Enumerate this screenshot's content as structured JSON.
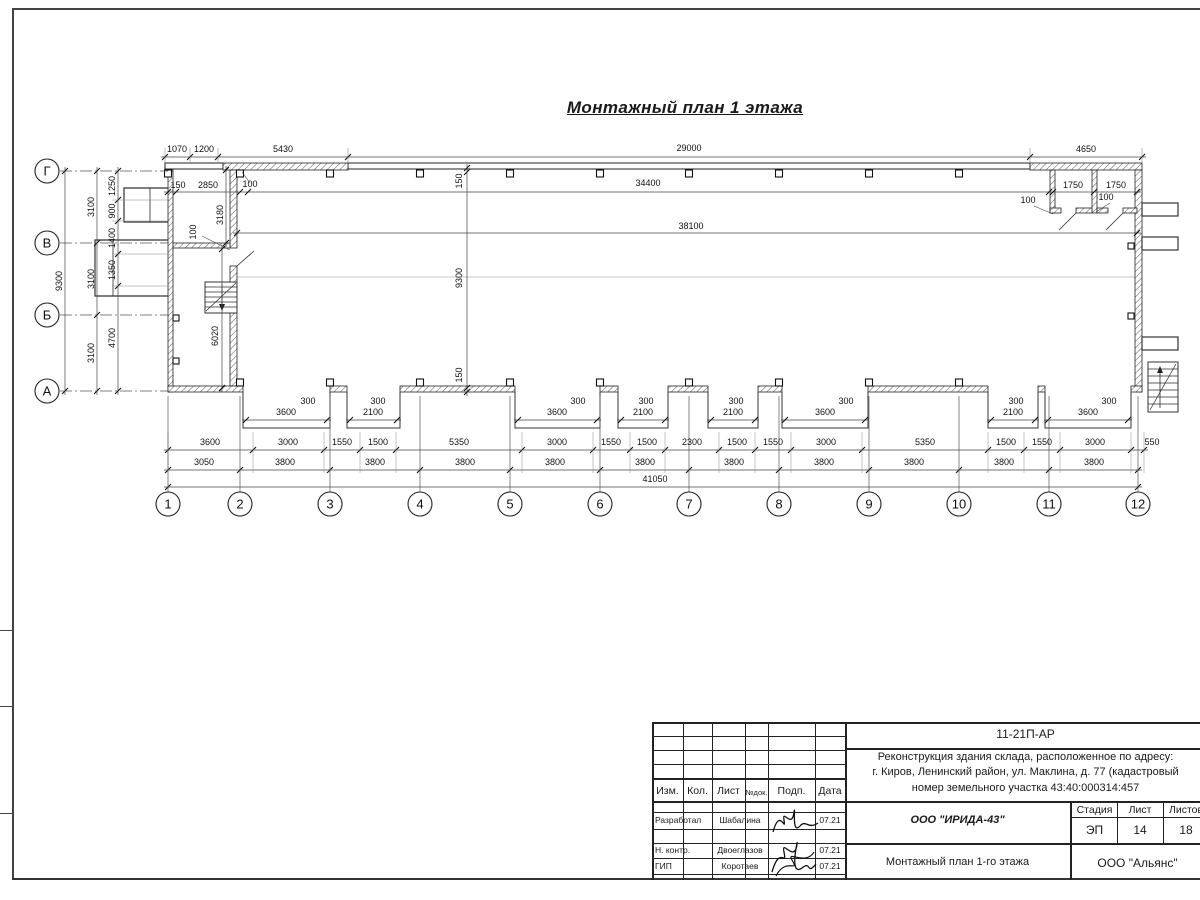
{
  "sheet": {
    "title": "Монтажный план 1 этажа"
  },
  "plan": {
    "axis_letters": [
      {
        "label": "Г",
        "y": 171
      },
      {
        "label": "В",
        "y": 243
      },
      {
        "label": "Б",
        "y": 315
      },
      {
        "label": "А",
        "y": 391
      }
    ],
    "axis_numbers": [
      {
        "label": "1",
        "x": 168
      },
      {
        "label": "2",
        "x": 240
      },
      {
        "label": "3",
        "x": 330
      },
      {
        "label": "4",
        "x": 420
      },
      {
        "label": "5",
        "x": 510
      },
      {
        "label": "6",
        "x": 600
      },
      {
        "label": "7",
        "x": 689
      },
      {
        "label": "8",
        "x": 779
      },
      {
        "label": "9",
        "x": 869
      },
      {
        "label": "10",
        "x": 959
      },
      {
        "label": "11",
        "x": 1049
      },
      {
        "label": "12",
        "x": 1138
      }
    ],
    "dim_labels": [
      {
        "t": "1070",
        "x": 177,
        "y": 152
      },
      {
        "t": "1200",
        "x": 204,
        "y": 152
      },
      {
        "t": "5430",
        "x": 283,
        "y": 152
      },
      {
        "t": "29000",
        "x": 689,
        "y": 151
      },
      {
        "t": "4650",
        "x": 1086,
        "y": 152
      },
      {
        "t": "150",
        "x": 178,
        "y": 188
      },
      {
        "t": "2850",
        "x": 208,
        "y": 188
      },
      {
        "t": "100",
        "x": 250,
        "y": 187
      },
      {
        "t": "34400",
        "x": 648,
        "y": 186
      },
      {
        "t": "1750",
        "x": 1073,
        "y": 188
      },
      {
        "t": "1750",
        "x": 1116,
        "y": 188
      },
      {
        "t": "100",
        "x": 1028,
        "y": 203
      },
      {
        "t": "100",
        "x": 1106,
        "y": 200
      },
      {
        "t": "38100",
        "x": 691,
        "y": 229
      },
      {
        "t": "3180",
        "x": 223,
        "y": 215,
        "r": 1
      },
      {
        "t": "100",
        "x": 196,
        "y": 232,
        "r": 1
      },
      {
        "t": "6020",
        "x": 218,
        "y": 336,
        "r": 1
      },
      {
        "t": "150",
        "x": 462,
        "y": 181,
        "r": 1
      },
      {
        "t": "9300",
        "x": 462,
        "y": 278,
        "r": 1
      },
      {
        "t": "150",
        "x": 462,
        "y": 375,
        "r": 1
      },
      {
        "t": "9300",
        "x": 62,
        "y": 281,
        "r": 1
      },
      {
        "t": "3100",
        "x": 94,
        "y": 207,
        "r": 1
      },
      {
        "t": "3100",
        "x": 94,
        "y": 279,
        "r": 1
      },
      {
        "t": "3100",
        "x": 94,
        "y": 353,
        "r": 1
      },
      {
        "t": "1250",
        "x": 115,
        "y": 186,
        "r": 1
      },
      {
        "t": "900",
        "x": 115,
        "y": 211,
        "r": 1
      },
      {
        "t": "1400",
        "x": 115,
        "y": 238,
        "r": 1
      },
      {
        "t": "1350",
        "x": 115,
        "y": 270,
        "r": 1
      },
      {
        "t": "4700",
        "x": 115,
        "y": 338,
        "r": 1
      },
      {
        "t": "3600",
        "x": 286,
        "y": 415
      },
      {
        "t": "2100",
        "x": 373,
        "y": 415
      },
      {
        "t": "3600",
        "x": 557,
        "y": 415
      },
      {
        "t": "2100",
        "x": 643,
        "y": 415
      },
      {
        "t": "2100",
        "x": 733,
        "y": 415
      },
      {
        "t": "3600",
        "x": 825,
        "y": 415
      },
      {
        "t": "2100",
        "x": 1013,
        "y": 415
      },
      {
        "t": "3600",
        "x": 1088,
        "y": 415
      },
      {
        "t": "300",
        "x": 308,
        "y": 404
      },
      {
        "t": "300",
        "x": 378,
        "y": 404
      },
      {
        "t": "300",
        "x": 578,
        "y": 404
      },
      {
        "t": "300",
        "x": 646,
        "y": 404
      },
      {
        "t": "300",
        "x": 736,
        "y": 404
      },
      {
        "t": "300",
        "x": 846,
        "y": 404
      },
      {
        "t": "300",
        "x": 1016,
        "y": 404
      },
      {
        "t": "300",
        "x": 1109,
        "y": 404
      },
      {
        "t": "3600",
        "x": 210,
        "y": 445
      },
      {
        "t": "3000",
        "x": 288,
        "y": 445
      },
      {
        "t": "1550",
        "x": 342,
        "y": 445
      },
      {
        "t": "1500",
        "x": 378,
        "y": 445
      },
      {
        "t": "5350",
        "x": 459,
        "y": 445
      },
      {
        "t": "3000",
        "x": 557,
        "y": 445
      },
      {
        "t": "1550",
        "x": 611,
        "y": 445
      },
      {
        "t": "1500",
        "x": 647,
        "y": 445
      },
      {
        "t": "2300",
        "x": 692,
        "y": 445
      },
      {
        "t": "1500",
        "x": 737,
        "y": 445
      },
      {
        "t": "1550",
        "x": 773,
        "y": 445
      },
      {
        "t": "3000",
        "x": 826,
        "y": 445
      },
      {
        "t": "5350",
        "x": 925,
        "y": 445
      },
      {
        "t": "1500",
        "x": 1006,
        "y": 445
      },
      {
        "t": "1550",
        "x": 1042,
        "y": 445
      },
      {
        "t": "3000",
        "x": 1095,
        "y": 445
      },
      {
        "t": "550",
        "x": 1152,
        "y": 445
      },
      {
        "t": "3050",
        "x": 204,
        "y": 465
      },
      {
        "t": "3800",
        "x": 285,
        "y": 465
      },
      {
        "t": "3800",
        "x": 375,
        "y": 465
      },
      {
        "t": "3800",
        "x": 465,
        "y": 465
      },
      {
        "t": "3800",
        "x": 555,
        "y": 465
      },
      {
        "t": "3800",
        "x": 645,
        "y": 465
      },
      {
        "t": "3800",
        "x": 734,
        "y": 465
      },
      {
        "t": "3800",
        "x": 824,
        "y": 465
      },
      {
        "t": "3800",
        "x": 914,
        "y": 465
      },
      {
        "t": "3800",
        "x": 1004,
        "y": 465
      },
      {
        "t": "3800",
        "x": 1094,
        "y": 465
      },
      {
        "t": "41050",
        "x": 655,
        "y": 482
      }
    ]
  },
  "titleblock": {
    "doc_number": "11-21П-АР",
    "project_line1": "Реконструкция здания склада, расположенное по адресу:",
    "project_line2": "г. Киров, Ленинский район, ул. Маклина, д. 77 (кадастровый",
    "project_line3": "номер земельного участка 43:40:000314:457",
    "col_izm": "Изм.",
    "col_kol": "Кол.",
    "col_list": "Лист",
    "col_ndok": "№док.",
    "col_podp": "Подп.",
    "col_data": "Дата",
    "rows": [
      {
        "role": "Разработал",
        "name": "Шабалина",
        "date": "07.21"
      },
      {
        "role": "Н. контр.",
        "name": "Двоеглазов",
        "date": "07.21"
      },
      {
        "role": "ГИП",
        "name": "Коротаев",
        "date": "07.21"
      }
    ],
    "org": "ООО \"ИРИДА-43\"",
    "sheet_title": "Монтажный план 1-го этажа",
    "stage_label": "Стадия",
    "stage": "ЭП",
    "sheet_label": "Лист",
    "sheet_no": "14",
    "sheets_label": "Листов",
    "sheets_total": "18",
    "company": "ООО \"Альянс\""
  }
}
